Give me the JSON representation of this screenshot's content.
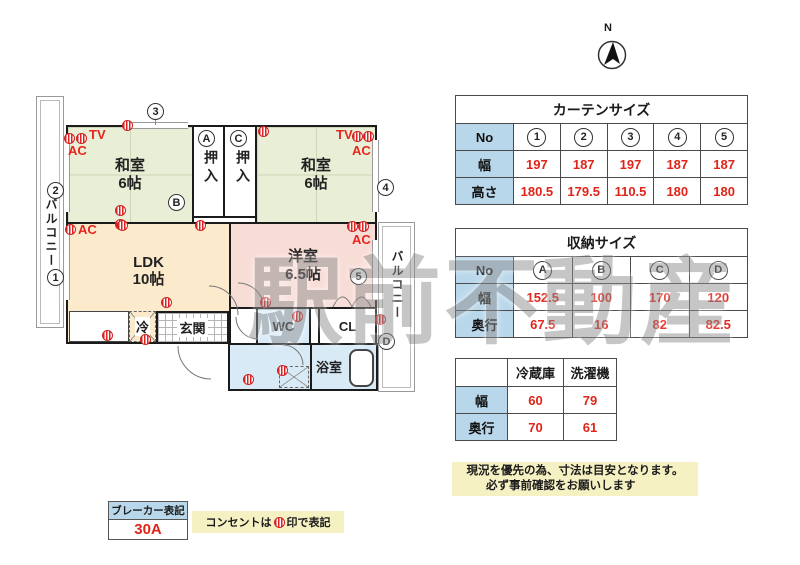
{
  "compass": {
    "label": "N"
  },
  "watermark": "駅前不動産",
  "floorplan": {
    "rooms": {
      "washitsu_left": "和室\n6帖",
      "washitsu_right": "和室\n6帖",
      "ldk": "LDK\n10帖",
      "yoshitsu": "洋室\n6.5帖",
      "genkan": "玄関",
      "wc": "WC",
      "cl": "CL",
      "bathroom": "浴室",
      "fridge": "冷",
      "closet_a": "押入",
      "closet_c": "押入",
      "balcony_left": "バルコニー",
      "balcony_right": "バルコニー"
    },
    "labels": {
      "tv": "TV",
      "ac": "AC"
    },
    "markers": {
      "w1": "1",
      "w2": "2",
      "w3": "3",
      "w4": "4",
      "w5": "5",
      "sA": "A",
      "sB": "B",
      "sC": "C",
      "sD": "D"
    }
  },
  "tables": {
    "curtain": {
      "title": "カーテンサイズ",
      "no_label": "No",
      "width_label": "幅",
      "height_label": "高さ",
      "columns": [
        "1",
        "2",
        "3",
        "4",
        "5"
      ],
      "widths": [
        "197",
        "187",
        "197",
        "187",
        "187"
      ],
      "heights": [
        "180.5",
        "179.5",
        "110.5",
        "180",
        "180"
      ]
    },
    "storage": {
      "title": "収納サイズ",
      "no_label": "No",
      "width_label": "幅",
      "depth_label": "奥行",
      "columns": [
        "A",
        "B",
        "C",
        "D"
      ],
      "widths": [
        "152.5",
        "100",
        "170",
        "120"
      ],
      "depths": [
        "67.5",
        "16",
        "82",
        "82.5"
      ]
    },
    "appliance": {
      "col_fridge": "冷蔵庫",
      "col_washer": "洗濯機",
      "width_label": "幅",
      "depth_label": "奥行",
      "widths": [
        "60",
        "79"
      ],
      "depths": [
        "70",
        "61"
      ]
    }
  },
  "notes": {
    "caution_line1": "現況を優先の為、寸法は目安となります。",
    "caution_line2": "必ず事前確認をお願いします",
    "breaker_title": "ブレーカー表記",
    "breaker_value": "30A",
    "outlet_prefix": "コンセントは",
    "outlet_suffix": "印で表記"
  },
  "colors": {
    "header_blue": "#b8d7ea",
    "value_red": "#e02419",
    "note_yellow": "#f5f1c3",
    "washitsu_green": "#e9efd6",
    "ldk_cream": "#fbeacb",
    "yoshitsu_pink": "#f8dcd6",
    "water_blue": "#d8eaf6"
  }
}
